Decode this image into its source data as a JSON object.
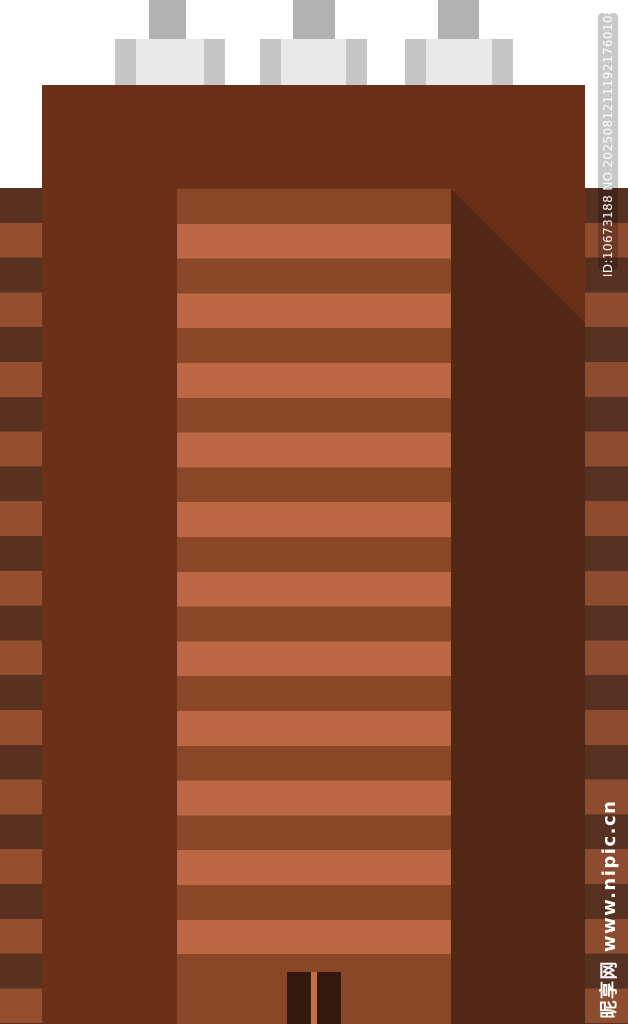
{
  "watermarks": {
    "id_text": "ID:10673188 NO.20250812111921760108",
    "site_text": "昵享网 www.nipic.cn"
  },
  "scene": {
    "subject": "flat-style brown skyscraper building illustration",
    "parts": [
      "chimney",
      "chimney",
      "chimney",
      "roof",
      "striped-side-wings",
      "window-stripes",
      "shadow",
      "double-door"
    ]
  },
  "colors": {
    "background": "#ffffff",
    "building_body": "#6b3118",
    "building_shadow": "#522716",
    "window_stripe_dark": "#8a4728",
    "window_stripe_light": "#bd6845",
    "left_wing_stripe_dark": "#583120",
    "left_wing_stripe_light": "#954e2e",
    "right_wing_stripe_dark": "#563021",
    "right_wing_stripe_light": "#8d4c2f",
    "door_panel": "#33190e",
    "door_gap": "#c4714a",
    "chimney_pipe": "#b2b2b2",
    "chimney_base_center": "#e9e9e9",
    "chimney_base_cap": "#c6c6c6",
    "watermark_strip_bg": "rgba(0,0,0,0.21)",
    "watermark_text": "#ffffff"
  }
}
